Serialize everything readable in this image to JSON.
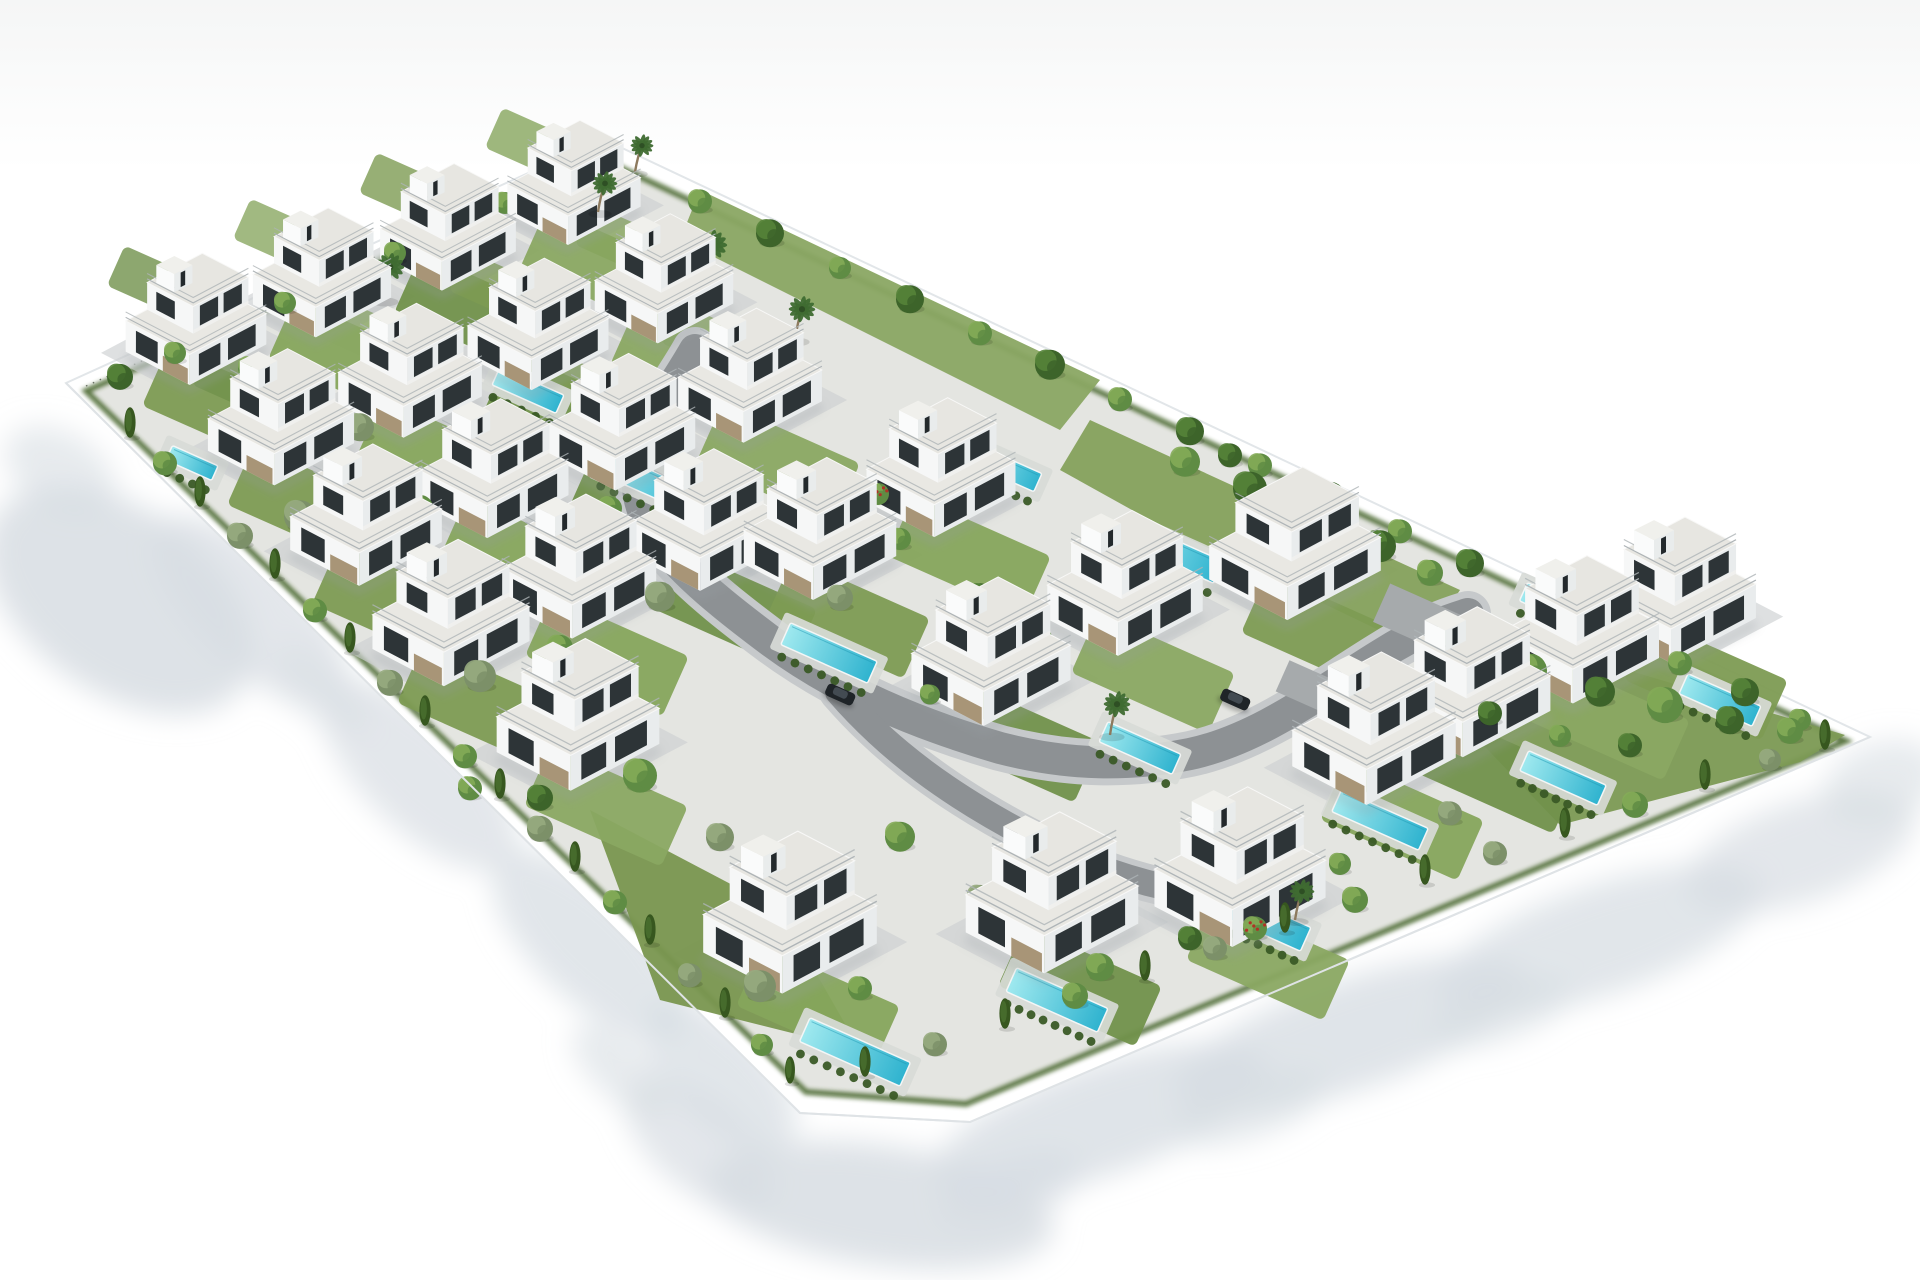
{
  "scene": {
    "title": "aerial-3d-render-villa-development",
    "canvas": {
      "w": 1920,
      "h": 1280,
      "bg": "#ffffff",
      "sky_top": "#f5f6f6"
    },
    "palette": {
      "ground": "#e4e5e1",
      "paving": "#ccd0d1",
      "road": "#8d9194",
      "curb": "#c6c9cb",
      "wall_fill": "#ffffff",
      "wall_edge": "#e2e6e9",
      "shadow": "#d7dde3",
      "pool_deep": "#2fb3cf",
      "pool_light": "#9fe9ef",
      "deck": "#d8dbd7",
      "hedge": "#3a5a26",
      "hedge_band": "#4a672f",
      "grass": [
        "#7d9b53",
        "#86a55c",
        "#71914b",
        "#8aa862"
      ],
      "tree_bright": [
        "#5f8c44",
        "#84ab58"
      ],
      "tree_dark": [
        "#3d642a",
        "#558339"
      ],
      "tree_olive": [
        "#7c9069",
        "#97ab80"
      ],
      "cypress": "#37571f",
      "palm": "#3f6b31",
      "palm_trunk": "#8d7a5e",
      "flower_dot": "#b03226",
      "villa_faceL": "#f6f7f7",
      "villa_faceR": "#e9eced",
      "villa_roof": "#e9e8e3",
      "villa_roof2": "#e7e6e1",
      "villa_window": "#2d3437",
      "villa_stone": "#a18c6b",
      "villa_rail": "#aeb4b7",
      "villa_shadow": "#9aa0a4",
      "car_body": "#1f2428",
      "car_roof": "#434b52"
    },
    "wall": {
      "outer": [
        [
          66,
          383
        ],
        [
          603,
          139
        ],
        [
          1870,
          737
        ],
        [
          970,
          1122
        ],
        [
          800,
          1113
        ]
      ],
      "inner": [
        [
          86,
          391
        ],
        [
          604,
          160
        ],
        [
          1846,
          741
        ],
        [
          966,
          1104
        ],
        [
          806,
          1092
        ]
      ]
    },
    "shadows": [
      [
        120,
        600,
        150,
        92,
        35,
        0.85
      ],
      [
        60,
        470,
        60,
        38,
        30,
        0.6
      ],
      [
        250,
        610,
        125,
        55,
        44,
        0.7
      ],
      [
        420,
        775,
        125,
        55,
        44,
        0.7
      ],
      [
        590,
        945,
        125,
        55,
        44,
        0.75
      ],
      [
        720,
        1075,
        95,
        48,
        44,
        0.75
      ],
      [
        880,
        1205,
        175,
        60,
        8,
        0.85
      ],
      [
        700,
        1145,
        90,
        45,
        40,
        0.7
      ],
      [
        1010,
        1190,
        75,
        32,
        -19,
        0.7
      ],
      [
        1100,
        1120,
        175,
        55,
        -19,
        0.8
      ],
      [
        1350,
        1035,
        185,
        55,
        -19,
        0.8
      ],
      [
        1600,
        940,
        170,
        55,
        -19,
        0.75
      ],
      [
        1800,
        852,
        120,
        50,
        -19,
        0.7
      ],
      [
        1882,
        782,
        60,
        40,
        -19,
        0.6
      ],
      [
        1250,
        1108,
        80,
        30,
        -19,
        0.6
      ],
      [
        1500,
        1012,
        75,
        28,
        -19,
        0.6
      ],
      [
        620,
        1070,
        60,
        28,
        43,
        0.6
      ],
      [
        320,
        690,
        60,
        28,
        43,
        0.5
      ]
    ],
    "road": {
      "main": "M695,350 C668,398 634,432 638,488 C642,540 700,588 772,642 C840,692 918,724 1000,748 C1070,766 1130,766 1190,754 C1260,739 1320,692 1382,654 C1420,630 1448,620 1468,614",
      "spur": "M838,692 C890,752 952,796 1028,836 C1078,862 1124,878 1168,888",
      "width": 32,
      "curb_width": 46,
      "pads": [
        [
          1425,
          622,
          95,
          42,
          24
        ],
        [
          1310,
          688,
          60,
          34,
          24
        ]
      ]
    },
    "gardens": [
      {
        "pts": [
          [
            1460,
            620
          ],
          [
            1845,
            735
          ],
          [
            1800,
            762
          ],
          [
            1560,
            825
          ],
          [
            1440,
            700
          ]
        ],
        "c": "#7c9a54"
      },
      {
        "pts": [
          [
            1090,
            420
          ],
          [
            1460,
            590
          ],
          [
            1420,
            650
          ],
          [
            1150,
            520
          ],
          [
            1060,
            470
          ]
        ],
        "c": "#85a15c"
      },
      {
        "pts": [
          [
            700,
            190
          ],
          [
            1100,
            380
          ],
          [
            1060,
            430
          ],
          [
            680,
            240
          ]
        ],
        "c": "#8aa763"
      },
      {
        "pts": [
          [
            590,
            810
          ],
          [
            780,
            910
          ],
          [
            860,
            1050
          ],
          [
            660,
            1000
          ]
        ],
        "c": "#79964f"
      }
    ],
    "pools": [
      [
        192,
        463,
        50,
        16
      ],
      [
        392,
        375,
        52,
        16
      ],
      [
        528,
        390,
        70,
        20
      ],
      [
        648,
        482,
        95,
        24
      ],
      [
        829,
        653,
        95,
        24
      ],
      [
        1005,
        468,
        72,
        20
      ],
      [
        1175,
        553,
        95,
        24
      ],
      [
        1140,
        748,
        80,
        22
      ],
      [
        1380,
        820,
        95,
        24
      ],
      [
        1563,
        778,
        85,
        22
      ],
      [
        1720,
        700,
        80,
        22
      ],
      [
        1560,
        608,
        80,
        20
      ],
      [
        770,
        920,
        70,
        20
      ],
      [
        855,
        1052,
        110,
        26
      ],
      [
        1057,
        1000,
        100,
        26
      ],
      [
        1260,
        919,
        100,
        26
      ]
    ],
    "villas": [
      {
        "x": 196,
        "y": 348
      },
      {
        "x": 322,
        "y": 301
      },
      {
        "x": 448,
        "y": 255
      },
      {
        "x": 574,
        "y": 210
      },
      {
        "x": 281,
        "y": 447
      },
      {
        "x": 410,
        "y": 400
      },
      {
        "x": 538,
        "y": 353
      },
      {
        "x": 664,
        "y": 307
      },
      {
        "x": 366,
        "y": 546
      },
      {
        "x": 494,
        "y": 499
      },
      {
        "x": 622,
        "y": 452
      },
      {
        "x": 750,
        "y": 405
      },
      {
        "x": 451,
        "y": 645
      },
      {
        "x": 579,
        "y": 598
      },
      {
        "x": 707,
        "y": 551
      },
      {
        "x": 578,
        "y": 748
      },
      {
        "x": 820,
        "y": 560
      },
      {
        "x": 941,
        "y": 498
      },
      {
        "x": 991,
        "y": 684
      },
      {
        "x": 1125,
        "y": 615
      },
      {
        "x": 1295,
        "y": 575,
        "t": 1
      },
      {
        "x": 1374,
        "y": 762
      },
      {
        "x": 1470,
        "y": 715
      },
      {
        "x": 1580,
        "y": 662
      },
      {
        "x": 1678,
        "y": 622
      },
      {
        "x": 790,
        "y": 948
      },
      {
        "x": 1052,
        "y": 928
      },
      {
        "x": 1240,
        "y": 902
      }
    ],
    "trees": [
      [
        120,
        384,
        13,
        5
      ],
      [
        175,
        359,
        11,
        0
      ],
      [
        230,
        334,
        14,
        5
      ],
      [
        285,
        309,
        11,
        0
      ],
      [
        340,
        284,
        13,
        5
      ],
      [
        395,
        259,
        11,
        0
      ],
      [
        450,
        234,
        13,
        5
      ],
      [
        505,
        209,
        11,
        0
      ],
      [
        560,
        185,
        12,
        5
      ],
      [
        600,
        163,
        11,
        5
      ],
      [
        130,
        436,
        9,
        2
      ],
      [
        165,
        470,
        12,
        0
      ],
      [
        200,
        505,
        9,
        2
      ],
      [
        240,
        543,
        13,
        1
      ],
      [
        275,
        577,
        9,
        2
      ],
      [
        315,
        617,
        12,
        0
      ],
      [
        350,
        651,
        9,
        2
      ],
      [
        390,
        690,
        13,
        1
      ],
      [
        425,
        724,
        9,
        2
      ],
      [
        465,
        763,
        12,
        0
      ],
      [
        500,
        797,
        9,
        2
      ],
      [
        540,
        836,
        13,
        1
      ],
      [
        575,
        870,
        9,
        2
      ],
      [
        615,
        909,
        12,
        0
      ],
      [
        650,
        943,
        9,
        2
      ],
      [
        690,
        982,
        12,
        1
      ],
      [
        725,
        1016,
        9,
        2
      ],
      [
        762,
        1051,
        11,
        0
      ],
      [
        790,
        1082,
        8,
        2
      ],
      [
        865,
        1075,
        9,
        2
      ],
      [
        935,
        1051,
        12,
        1
      ],
      [
        1005,
        1027,
        9,
        2
      ],
      [
        1075,
        1003,
        13,
        0
      ],
      [
        1145,
        979,
        9,
        2
      ],
      [
        1215,
        955,
        12,
        1
      ],
      [
        1285,
        931,
        9,
        2
      ],
      [
        1355,
        907,
        13,
        0
      ],
      [
        1425,
        883,
        9,
        2
      ],
      [
        1495,
        860,
        12,
        1
      ],
      [
        1565,
        836,
        9,
        2
      ],
      [
        1635,
        812,
        13,
        0
      ],
      [
        1705,
        788,
        9,
        2
      ],
      [
        1770,
        766,
        11,
        1
      ],
      [
        1825,
        748,
        9,
        2
      ],
      [
        700,
        208,
        12,
        0
      ],
      [
        770,
        241,
        14,
        5
      ],
      [
        840,
        274,
        11,
        0
      ],
      [
        910,
        307,
        14,
        5
      ],
      [
        980,
        340,
        12,
        0
      ],
      [
        1050,
        373,
        15,
        5
      ],
      [
        1120,
        406,
        12,
        0
      ],
      [
        1190,
        439,
        14,
        5
      ],
      [
        1260,
        472,
        12,
        0
      ],
      [
        1330,
        505,
        15,
        5
      ],
      [
        1400,
        538,
        12,
        0
      ],
      [
        1470,
        571,
        14,
        5
      ],
      [
        1540,
        604,
        12,
        0
      ],
      [
        1610,
        637,
        15,
        5
      ],
      [
        1680,
        670,
        12,
        0
      ],
      [
        1745,
        700,
        14,
        5
      ],
      [
        1800,
        726,
        11,
        0
      ],
      [
        1530,
        680,
        17,
        0
      ],
      [
        1600,
        700,
        15,
        5
      ],
      [
        1665,
        715,
        18,
        0
      ],
      [
        1730,
        728,
        14,
        5
      ],
      [
        1790,
        738,
        13,
        0
      ],
      [
        1490,
        720,
        12,
        5
      ],
      [
        1560,
        742,
        11,
        0
      ],
      [
        1630,
        752,
        12,
        5
      ],
      [
        1185,
        470,
        15,
        0
      ],
      [
        1250,
        498,
        17,
        5
      ],
      [
        1315,
        525,
        13,
        0
      ],
      [
        1380,
        555,
        16,
        5
      ],
      [
        1300,
        500,
        12,
        0
      ],
      [
        1230,
        462,
        12,
        5
      ],
      [
        1430,
        580,
        13,
        0
      ],
      [
        250,
        375,
        12,
        0
      ],
      [
        360,
        435,
        14,
        1
      ],
      [
        300,
        525,
        16,
        1
      ],
      [
        420,
        515,
        13,
        0
      ],
      [
        520,
        475,
        15,
        5
      ],
      [
        610,
        515,
        12,
        0
      ],
      [
        660,
        605,
        15,
        1
      ],
      [
        560,
        655,
        13,
        0
      ],
      [
        480,
        685,
        16,
        1
      ],
      [
        400,
        625,
        12,
        5
      ],
      [
        640,
        785,
        17,
        0
      ],
      [
        720,
        845,
        14,
        1
      ],
      [
        540,
        805,
        13,
        5
      ],
      [
        470,
        795,
        12,
        0
      ],
      [
        840,
        605,
        13,
        1
      ],
      [
        900,
        545,
        11,
        0
      ],
      [
        980,
        605,
        14,
        5
      ],
      [
        1040,
        645,
        12,
        0
      ],
      [
        900,
        845,
        15,
        0
      ],
      [
        980,
        905,
        13,
        1
      ],
      [
        1100,
        975,
        14,
        0
      ],
      [
        1190,
        945,
        12,
        5
      ],
      [
        860,
        995,
        12,
        0
      ],
      [
        760,
        995,
        16,
        1
      ],
      [
        820,
        945,
        13,
        4
      ],
      [
        1255,
        935,
        12,
        4
      ],
      [
        1340,
        870,
        11,
        0
      ],
      [
        1450,
        820,
        12,
        1
      ],
      [
        930,
        700,
        10,
        0
      ],
      [
        878,
        500,
        11,
        4
      ],
      [
        383,
        300,
        15,
        3
      ],
      [
        520,
        318,
        14,
        3
      ],
      [
        705,
        280,
        16,
        3
      ],
      [
        795,
        340,
        14,
        3
      ],
      [
        565,
        195,
        15,
        3
      ],
      [
        598,
        212,
        13,
        3
      ],
      [
        1110,
        735,
        14,
        3
      ],
      [
        1295,
        920,
        13,
        3
      ],
      [
        635,
        172,
        12,
        3
      ]
    ],
    "cars": [
      [
        840,
        695,
        24
      ],
      [
        1235,
        700,
        24
      ]
    ]
  }
}
